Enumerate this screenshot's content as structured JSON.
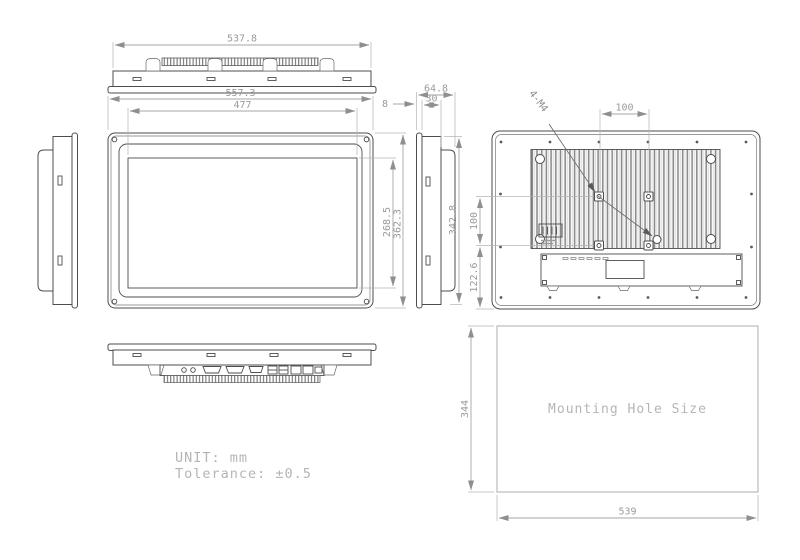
{
  "dimensions": {
    "top": {
      "width": "537.8"
    },
    "front": {
      "outer_width": "557.3",
      "display_width": "477",
      "display_height": "268.5",
      "outer_height": "362.3"
    },
    "side": {
      "total_depth": "64.8",
      "body_depth": "30",
      "bezel_depth": "8",
      "body_height": "342.8"
    },
    "back": {
      "vesa_horizontal": "100",
      "vesa_vertical": "100",
      "bottom_offset": "122.6",
      "thread_label": "4-M4"
    },
    "mounting": {
      "label": "Mounting Hole Size",
      "width": "539",
      "height": "344"
    }
  },
  "notes": {
    "unit": "UNIT: mm",
    "tolerance": "Tolerance: ±0.5"
  }
}
